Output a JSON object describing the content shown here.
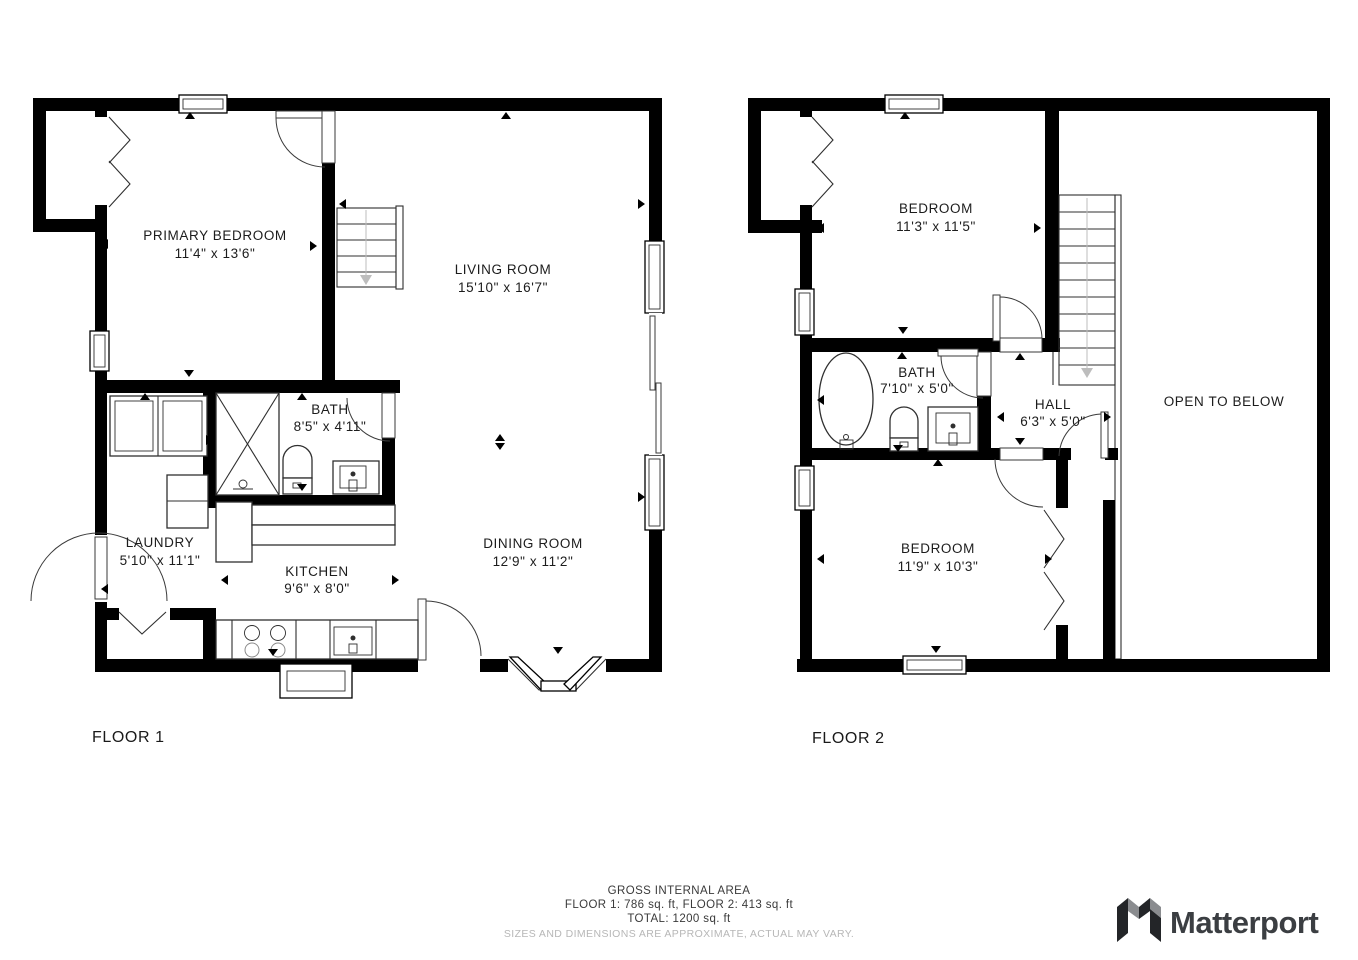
{
  "floor1": {
    "label": "FLOOR 1",
    "rooms": [
      {
        "name": "PRIMARY BEDROOM",
        "dims": "11'4\" x 13'6\""
      },
      {
        "name": "LIVING ROOM",
        "dims": "15'10\" x 16'7\""
      },
      {
        "name": "BATH",
        "dims": "8'5\" x 4'11\""
      },
      {
        "name": "LAUNDRY",
        "dims": "5'10\" x 11'1\""
      },
      {
        "name": "KITCHEN",
        "dims": "9'6\" x 8'0\""
      },
      {
        "name": "DINING ROOM",
        "dims": "12'9\" x 11'2\""
      }
    ]
  },
  "floor2": {
    "label": "FLOOR 2",
    "rooms": [
      {
        "name": "BEDROOM",
        "dims": "11'3\" x 11'5\""
      },
      {
        "name": "BATH",
        "dims": "7'10\" x 5'0\""
      },
      {
        "name": "HALL",
        "dims": "6'3\" x 5'0\""
      },
      {
        "name": "BEDROOM",
        "dims": "11'9\" x 10'3\""
      },
      {
        "name": "OPEN TO BELOW",
        "dims": ""
      }
    ]
  },
  "footer": {
    "title": "GROSS INTERNAL AREA",
    "line1": "FLOOR 1: 786 sq. ft, FLOOR 2: 413 sq. ft",
    "line2": "TOTAL: 1200 sq. ft",
    "disclaimer": "SIZES AND DIMENSIONS ARE APPROXIMATE, ACTUAL MAY VARY."
  },
  "branding": {
    "logo_text": "Matterport"
  },
  "colors": {
    "wall": "#000000",
    "line": "#2f2f2f",
    "muted_text": "#b7b7b7",
    "stair_arrow": "#bdbdbd",
    "logo_dark": "#232528",
    "logo_gray": "#8a8c8f",
    "logo_text": "#3b3e42"
  }
}
